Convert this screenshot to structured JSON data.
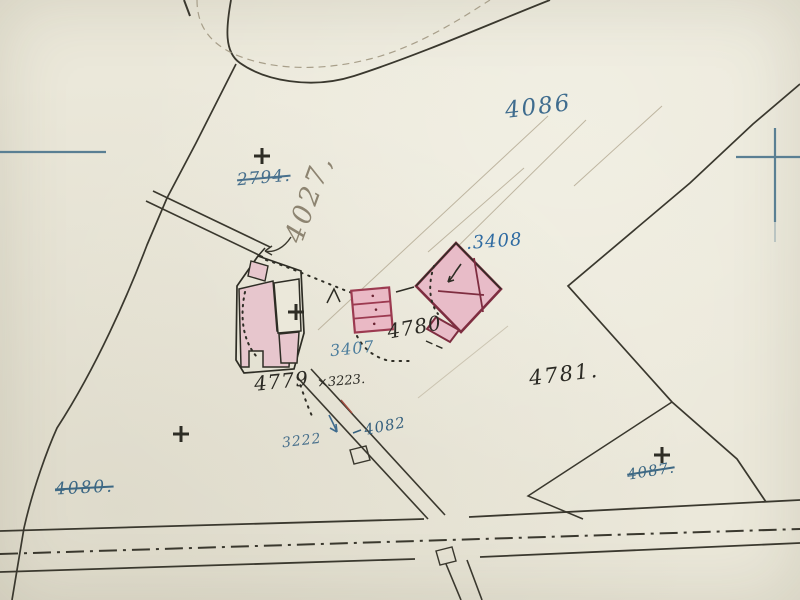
{
  "map_type": "cadastral-survey-map-scan",
  "colors": {
    "paper": "#ebe8da",
    "ink_black": "#35342b",
    "ink_blue": "#3f6c8e",
    "pencil_gray": "#8d8471",
    "building_fill": "#e9c3cc",
    "building_outline": "#7e2d40",
    "registration_mark_blue": "#5a7f93"
  },
  "labels": {
    "l4086": {
      "text": "4086"
    },
    "l2794": {
      "text": "2794."
    },
    "l4027": {
      "text": "4027,"
    },
    "l3408": {
      "text": ".3408"
    },
    "l4780": {
      "text": "4780"
    },
    "l3407": {
      "text": "3407"
    },
    "l4781": {
      "text": "4781."
    },
    "l4779": {
      "text": "4779"
    },
    "l3223": {
      "text": "×3223."
    },
    "l3222": {
      "text": "3222"
    },
    "l4082": {
      "text": "4082"
    },
    "l4080": {
      "text": "4080."
    },
    "l4087": {
      "text": "4087."
    }
  },
  "symbols": {
    "survey_cross_count": 4,
    "registration_marks": [
      "left-edge-tick",
      "right-edge-cross"
    ]
  }
}
